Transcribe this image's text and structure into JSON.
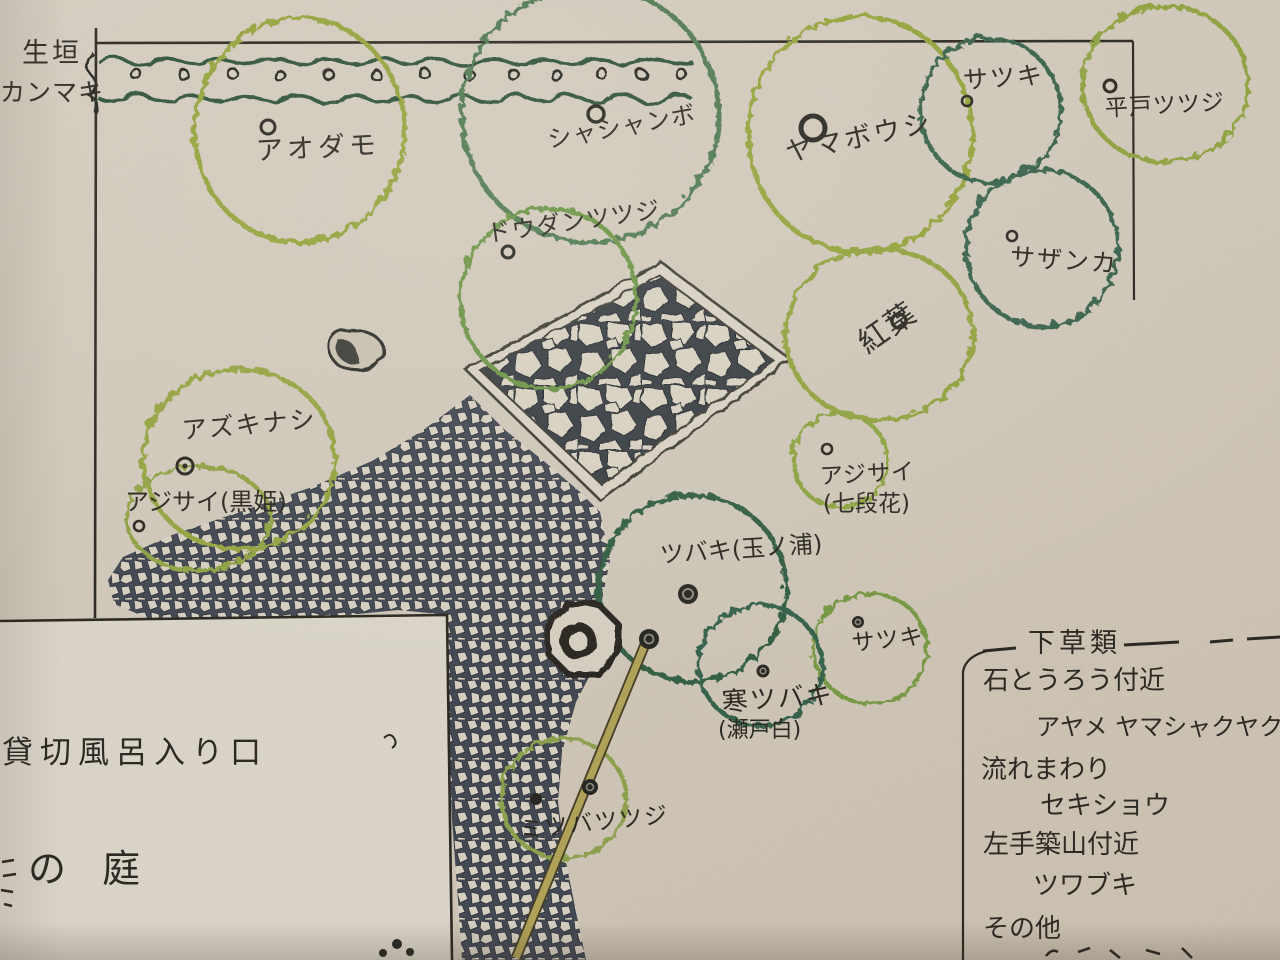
{
  "plan": {
    "hedge": {
      "label_top": "生垣",
      "label_bottom": "カンマキ"
    },
    "plants": [
      {
        "id": "aodamo",
        "name": "アオダモ"
      },
      {
        "id": "shashanbo",
        "name": "シャシャンボ"
      },
      {
        "id": "yamaboushi",
        "name": "ヤマボウシ"
      },
      {
        "id": "satsuki-top",
        "name": "サツキ"
      },
      {
        "id": "hirado-tsutsuji",
        "name": "平戸ツツジ"
      },
      {
        "id": "doudan-tsutsuji",
        "name": "ドウダンツツジ"
      },
      {
        "id": "sazanka",
        "name": "サザンカ"
      },
      {
        "id": "momiji",
        "name": "紅葉"
      },
      {
        "id": "azukinashi",
        "name": "アズキナシ"
      },
      {
        "id": "ajisai-kurohime",
        "name": "アジサイ(黒姫)"
      },
      {
        "id": "ajisai-shichidanka",
        "name": "アジサイ",
        "variety": "(七段花)"
      },
      {
        "id": "tsubaki-tamanoura",
        "name": "ツバキ(玉ノ浦)"
      },
      {
        "id": "satsuki-mid",
        "name": "サツキ"
      },
      {
        "id": "kan-tsubaki",
        "name": "寒ツバキ",
        "variety": "(瀬戸白)"
      },
      {
        "id": "mitsuba-tsutsuji",
        "name": "ミツバツツジ"
      }
    ],
    "card": {
      "line1": "貸切風呂入り口",
      "line2": "の 庭"
    },
    "understory": {
      "heading": "下草類",
      "lines": [
        {
          "text": "石とうろう付近"
        },
        {
          "text": "アヤメ ヤマシャクヤク"
        },
        {
          "text": "流れまわり"
        },
        {
          "text": "セキショウ"
        },
        {
          "text": "左手築山付近"
        },
        {
          "text": "ツワブキ"
        },
        {
          "text": "その他"
        }
      ]
    },
    "features": {
      "terrace": "stone-paving-terrace",
      "path": "pebble-path",
      "lantern": "stone-lantern",
      "pole": "bamboo-pole",
      "rock": "garden-rock"
    },
    "palette": {
      "paper": "#cdc5b6",
      "ink": "#2d2a24",
      "light_green": "#93a23c",
      "medium_green": "#6a9342",
      "dark_green": "#335f46",
      "pole_tan": "#b0a055"
    }
  }
}
